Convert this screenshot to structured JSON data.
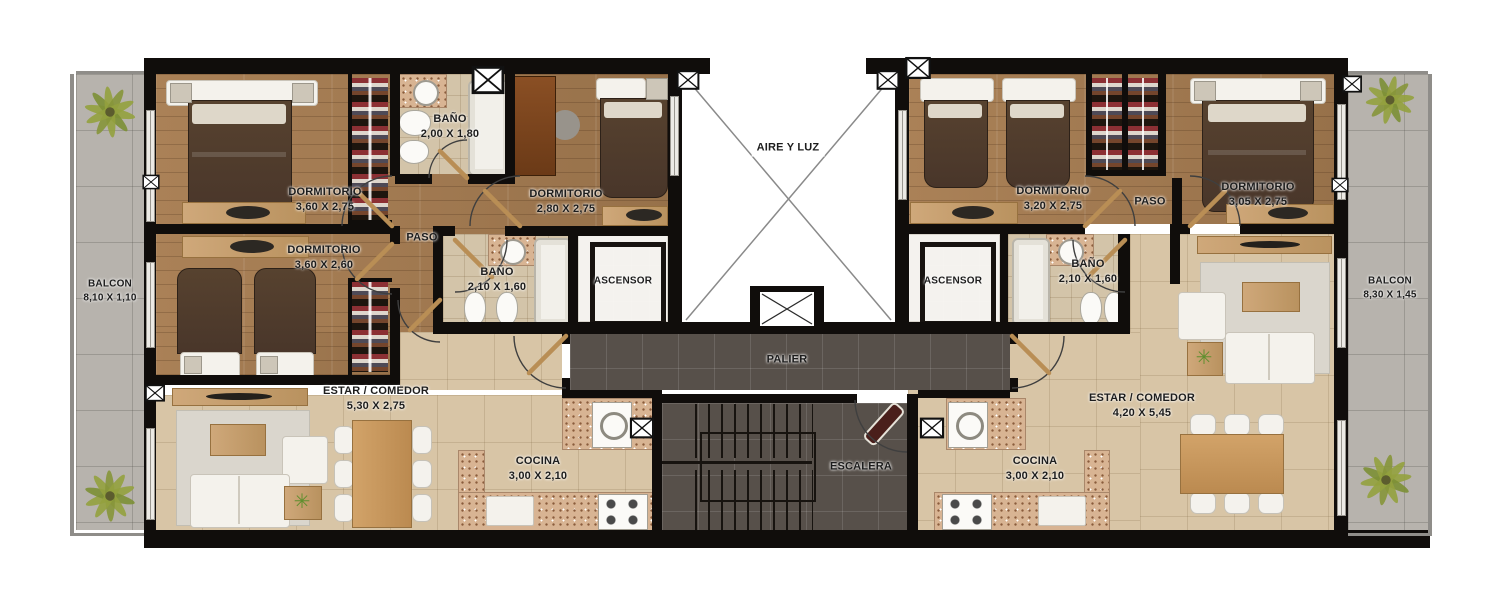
{
  "plan_type": "apartment-floor-plan",
  "labels": {
    "balcon_left": {
      "name": "BALCON",
      "dims": "8,10 X 1,10"
    },
    "balcon_right": {
      "name": "BALCON",
      "dims": "8,30 X 1,45"
    },
    "dorm1": {
      "name": "DORMITORIO",
      "dims": "3,60 X 2,75"
    },
    "dorm2": {
      "name": "DORMITORIO",
      "dims": "2,80 X 2,75"
    },
    "dorm3": {
      "name": "DORMITORIO",
      "dims": "3,60 X 2,60"
    },
    "dorm4": {
      "name": "DORMITORIO",
      "dims": "3,20 X 2,75"
    },
    "dorm5": {
      "name": "DORMITORIO",
      "dims": "3,05 X 2,75"
    },
    "bano1": {
      "name": "BAÑO",
      "dims": "2,00 X 1,80"
    },
    "bano2": {
      "name": "BAÑO",
      "dims": "2,10 X 1,60"
    },
    "bano3": {
      "name": "BAÑO",
      "dims": "2,10 X 1,60"
    },
    "paso_left": {
      "name": "PASO"
    },
    "paso_right": {
      "name": "PASO"
    },
    "ascensor_left": {
      "name": "ASCENSOR"
    },
    "ascensor_right": {
      "name": "ASCENSOR"
    },
    "aire_y_luz": {
      "name": "AIRE Y LUZ"
    },
    "palier": {
      "name": "PALIER"
    },
    "escalera": {
      "name": "ESCALERA"
    },
    "estar_left": {
      "name": "ESTAR / COMEDOR",
      "dims": "5,30 X 2,75"
    },
    "estar_right": {
      "name": "ESTAR / COMEDOR",
      "dims": "4,20 X 5,45"
    },
    "cocina_left": {
      "name": "COCINA",
      "dims": "3,00 X 2,10"
    },
    "cocina_right": {
      "name": "COCINA",
      "dims": "3,00 X 2,10"
    }
  },
  "icons": {
    "plant_glyph": "✳"
  },
  "colors": {
    "wall": "#100d0b",
    "wood_floor": "#a1784e",
    "tile_floor": "#d8c5a6",
    "bath_tile": "#d3c4a9",
    "balcony_tile": "#b7b3ad",
    "palier_tile": "#57504a",
    "bed_blanket": "#4e3a2b",
    "counter_speckle": "#d8b493",
    "furniture_white": "#f4f2ec",
    "door_wood": "#b98e55",
    "plant_green": "#93a13e",
    "label_text": "#1d1d1d"
  }
}
